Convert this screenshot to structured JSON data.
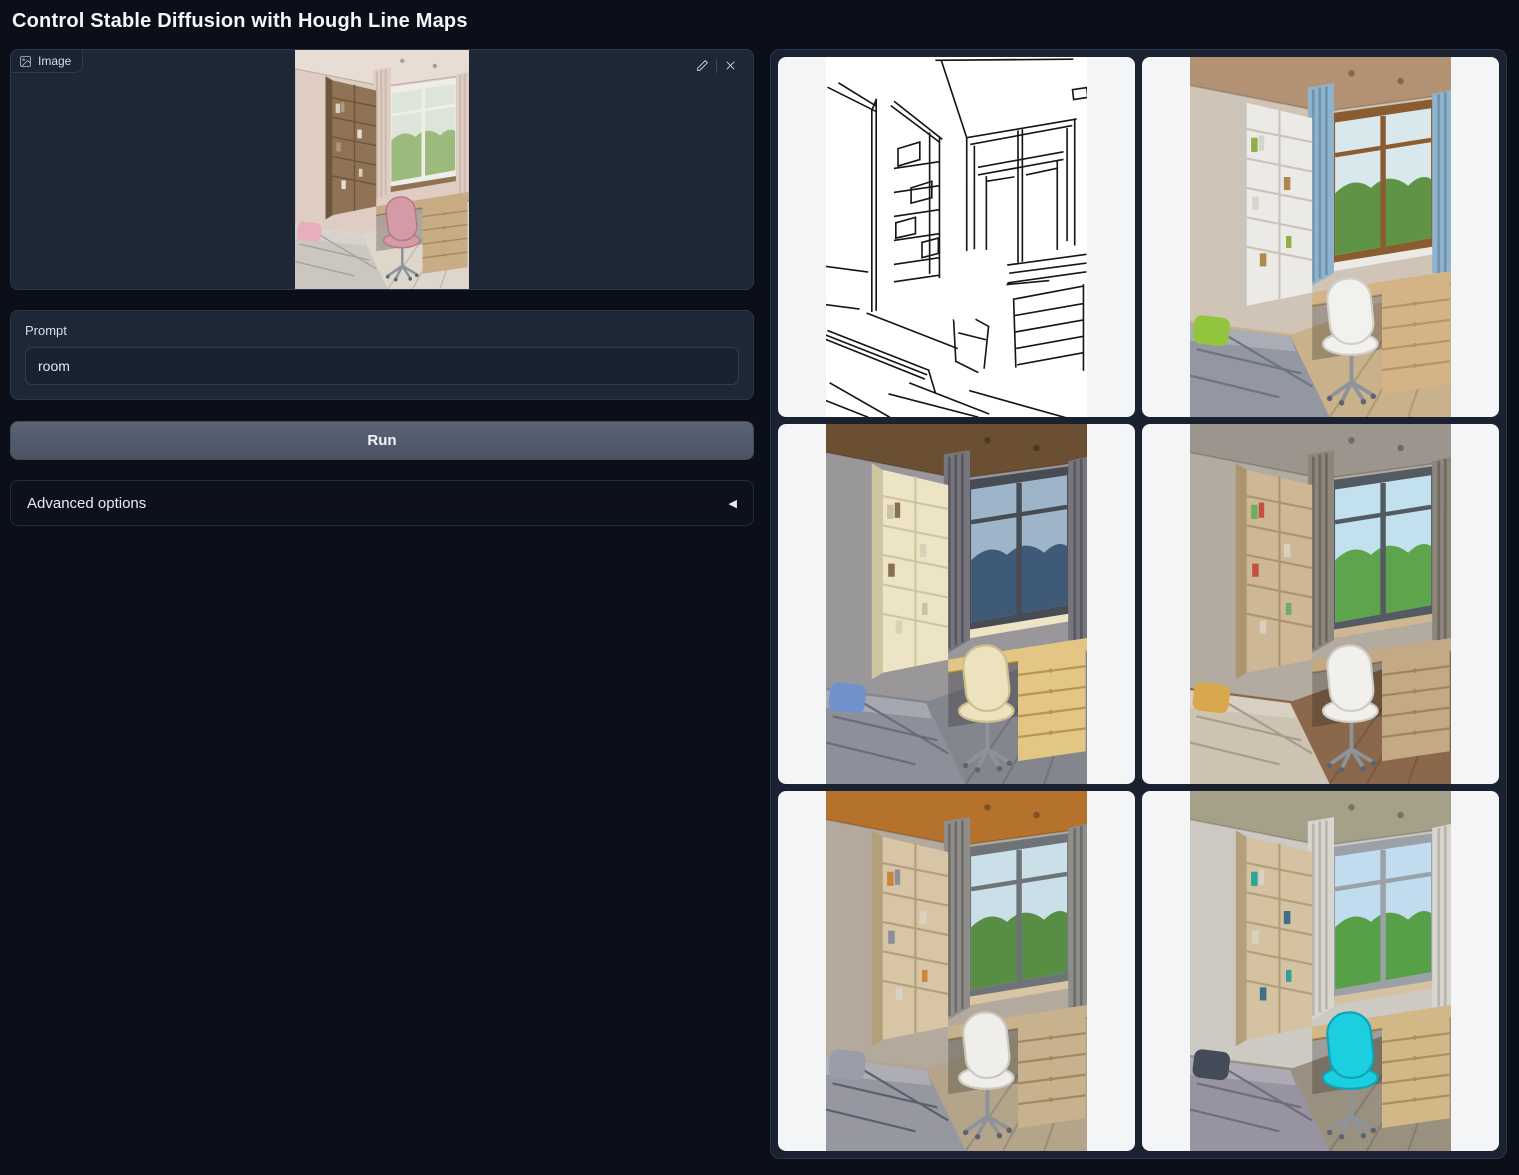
{
  "page": {
    "title": "Control Stable Diffusion with Hough Line Maps"
  },
  "colors": {
    "background": "#0b0f19",
    "panel": "#1d2735",
    "panel_border": "#2c3748",
    "button": "#4f5866",
    "gallery_card": "#f4f5f7"
  },
  "image_input": {
    "label": "Image",
    "alt": "Photo of a child bedroom with wooden shelf, window, desk and pink chair",
    "palette": {
      "wall": "#dfccc3",
      "ceiling": "#e7ddd4",
      "curtain": "#dfccc3",
      "curtainDark": "#cbb8ae",
      "shelf": "#8f7354",
      "shelfLine": "#6e563c",
      "frame": "#efedea",
      "view_sky": "#dce5d8",
      "view_green": "#9cba7b",
      "bed": "#ccc6c0",
      "bedDark": "#a8a29c",
      "pillow": "#e8aebb",
      "chair": "#d49aa6",
      "chairDark": "#b07986",
      "desk": "#c8ac84",
      "deskDark": "#a58a61",
      "floor": "#ddd6ca",
      "books": [
        "#d8cfc2",
        "#b09a7c",
        "#e5ded2"
      ]
    }
  },
  "prompt": {
    "label": "Prompt",
    "value": "room"
  },
  "run_button": {
    "label": "Run"
  },
  "advanced": {
    "label": "Advanced options",
    "collapse_icon": "◀"
  },
  "gallery": {
    "items": [
      {
        "type": "hough",
        "alt": "Hough line map sketch of the room"
      },
      {
        "type": "room",
        "alt": "Render with blue curtains, green pillow, white chair, wooden window",
        "palette": {
          "wall": "#cfc4b6",
          "ceiling": "#b29272",
          "curtain": "#8fb3cc",
          "curtainDark": "#6f94ad",
          "shelf": "#eceae6",
          "shelfLine": "#c9c5bd",
          "frame": "#8a5c30",
          "view_sky": "#d8e8ec",
          "view_green": "#5f9447",
          "bed": "#9297a1",
          "bedDark": "#6e7380",
          "pillow": "#93c43e",
          "chair": "#f2f1ed",
          "chairDark": "#cfcec8",
          "desk": "#d4b486",
          "deskDark": "#b59465",
          "floor": "#c9b18c",
          "books": [
            "#8fae4a",
            "#d9d4c9",
            "#b0884f"
          ]
        }
      },
      {
        "type": "room",
        "alt": "Render with dark curtains, wooden ceiling, blue pillow, cream chair, dusk view",
        "palette": {
          "wall": "#9a979a",
          "ceiling": "#6b4f33",
          "curtain": "#77757c",
          "curtainDark": "#595862",
          "shelf": "#ece4c4",
          "shelfLine": "#cfc6a0",
          "frame": "#474c54",
          "view_sky": "#9db4c9",
          "view_green": "#3e5a77",
          "bed": "#8c909a",
          "bedDark": "#696d78",
          "pillow": "#7191cc",
          "chair": "#ece2bd",
          "chairDark": "#cbbf92",
          "desk": "#e3c683",
          "deskDark": "#b8964e",
          "floor": "#83868d",
          "books": [
            "#c9c2a8",
            "#8a6f4f",
            "#d9d2ba"
          ]
        }
      },
      {
        "type": "room",
        "alt": "Render with taupe curtains, yellow pillow, white chair, bright green trees",
        "palette": {
          "wall": "#b3aaa0",
          "ceiling": "#9b958d",
          "curtain": "#8d867b",
          "curtainDark": "#6f695f",
          "shelf": "#cdb795",
          "shelfLine": "#ab9571",
          "frame": "#545a61",
          "view_sky": "#c2e0ee",
          "view_green": "#5ea44c",
          "bed": "#cec3b2",
          "bedDark": "#a89d8b",
          "pillow": "#d7a84e",
          "chair": "#f1f0ec",
          "chairDark": "#cecdc6",
          "desk": "#c3aa85",
          "deskDark": "#9e855e",
          "floor": "#8b684c",
          "books": [
            "#6fae62",
            "#c2513f",
            "#d8d0bd"
          ]
        }
      },
      {
        "type": "room",
        "alt": "Render with orange wood ceiling, gray curtains, patterned gray bedding, white chair",
        "palette": {
          "wall": "#b3a99d",
          "ceiling": "#b4722c",
          "curtain": "#908e8b",
          "curtainDark": "#6f6d6a",
          "shelf": "#d8c5a6",
          "shelfLine": "#b4a078",
          "frame": "#6e7378",
          "view_sky": "#cadfe8",
          "view_green": "#578e44",
          "bed": "#9697a0",
          "bedDark": "#5c606c",
          "pillow": "#9a9eab",
          "chair": "#efeeea",
          "chairDark": "#c9c8c1",
          "desk": "#c8b28d",
          "deskDark": "#a08960",
          "floor": "#b3a48a",
          "books": [
            "#c9863f",
            "#8a8f98",
            "#d8d2c2"
          ]
        }
      },
      {
        "type": "room",
        "alt": "Render with olive ceiling, bright cyan chair, gray bed, green trees",
        "palette": {
          "wall": "#cdc9c3",
          "ceiling": "#a5a189",
          "curtain": "#d8d5cf",
          "curtainDark": "#b8b5ae",
          "shelf": "#d5c2a1",
          "shelfLine": "#b2a07c",
          "frame": "#9ba1a7",
          "view_sky": "#c0dcee",
          "view_green": "#58a047",
          "bed": "#9893a0",
          "bedDark": "#716c7c",
          "pillow": "#434a58",
          "chair": "#1ccfe0",
          "chairDark": "#0fa4b8",
          "desk": "#d2b787",
          "deskDark": "#ab8f5d",
          "floor": "#99907f",
          "books": [
            "#2fa39a",
            "#d8d2c4",
            "#3e6e8a"
          ]
        }
      }
    ]
  }
}
